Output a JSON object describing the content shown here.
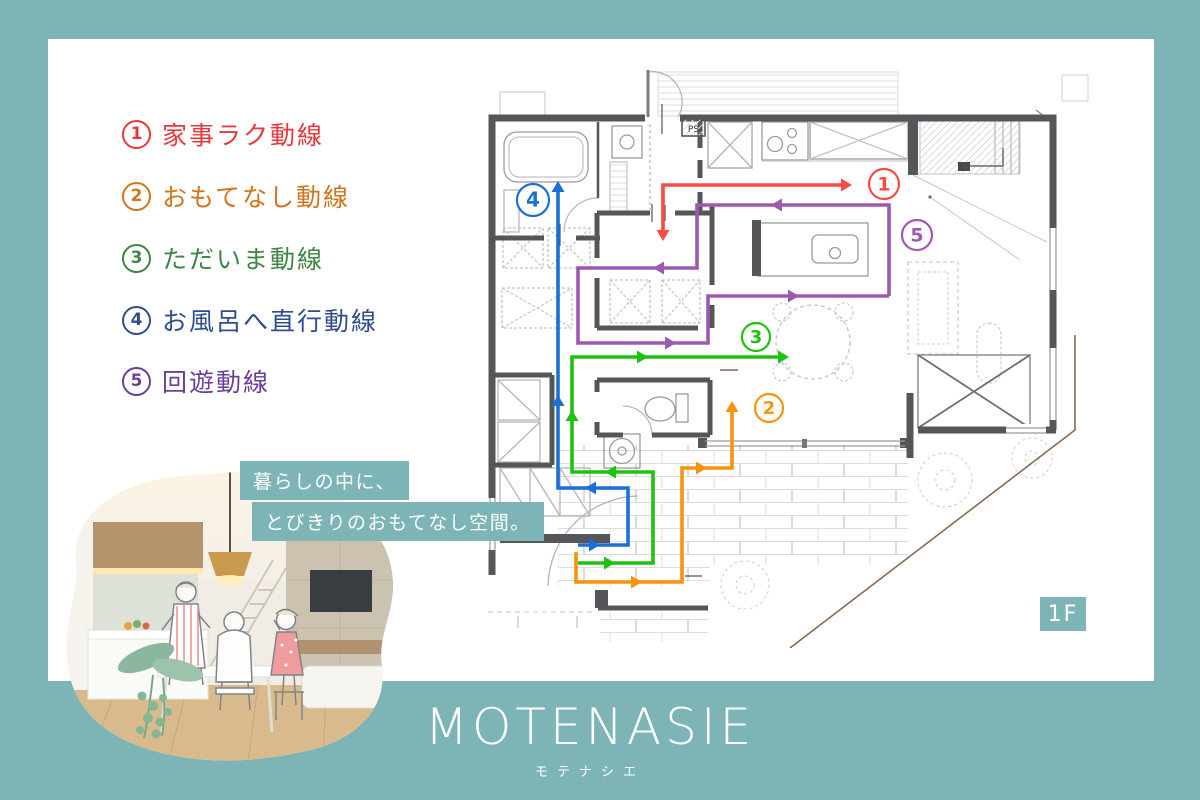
{
  "palette": {
    "teal": "#7db5b7",
    "card_bg": "#ffffff",
    "wall": "#55565a",
    "plan_line": "#9b9b9b",
    "property_line": "#8a6a50"
  },
  "legend": {
    "items": [
      {
        "number": "1",
        "label": "家事ラク動線",
        "color": "#e8383d"
      },
      {
        "number": "2",
        "label": "おもてなし動線",
        "color": "#d1761b"
      },
      {
        "number": "3",
        "label": "ただいま動線",
        "color": "#3d8544"
      },
      {
        "number": "4",
        "label": "お風呂へ直行動線",
        "color": "#2e4d91"
      },
      {
        "number": "5",
        "label": "回遊動線",
        "color": "#6a3f9b"
      }
    ]
  },
  "bubble": {
    "line1": "暮らしの中に、",
    "line2": "とびきりのおもてなし空間。"
  },
  "logo": {
    "name": "MOTENASIE",
    "kana": "モテナシエ"
  },
  "plan": {
    "floor_label": "1F",
    "ps_label": "PS",
    "routes": [
      {
        "number": "1",
        "name": "kaji-raku-dousen",
        "color": "#fa4b43",
        "points": "183,176 183,125 366,125",
        "arrows": [
          {
            "x": 183,
            "y": 181,
            "d": "down"
          },
          {
            "x": 372,
            "y": 125,
            "d": "right"
          }
        ],
        "badge": {
          "x": 404,
          "y": 124,
          "r": 15
        }
      },
      {
        "number": "2",
        "name": "omotenashi-dousen",
        "color": "#f7930f",
        "points": "96,492 96,522 202,522 202,408 252,408 252,347",
        "arrows": [
          {
            "x": 162,
            "y": 522,
            "d": "right"
          },
          {
            "x": 227,
            "y": 408,
            "d": "right"
          },
          {
            "x": 252,
            "y": 341,
            "d": "up"
          }
        ],
        "badge": {
          "x": 289,
          "y": 348,
          "r": 14
        }
      },
      {
        "number": "3",
        "name": "tadaima-dousen",
        "color": "#1fc20f",
        "points": "98,503 173,503 173,412 92,412 92,297 303,297",
        "arrows": [
          {
            "x": 135,
            "y": 503,
            "d": "right"
          },
          {
            "x": 125,
            "y": 412,
            "d": "left"
          },
          {
            "x": 92,
            "y": 350,
            "d": "up"
          },
          {
            "x": 168,
            "y": 297,
            "d": "right"
          },
          {
            "x": 309,
            "y": 297,
            "d": "right"
          }
        ],
        "badge": {
          "x": 276,
          "y": 277,
          "r": 14
        }
      },
      {
        "number": "4",
        "name": "ofuro-chokkou-dousen",
        "color": "#1b6fd6",
        "points": "98,485 148,485 148,428 78,428 78,127",
        "arrows": [
          {
            "x": 120,
            "y": 485,
            "d": "right"
          },
          {
            "x": 105,
            "y": 428,
            "d": "left"
          },
          {
            "x": 78,
            "y": 335,
            "d": "up"
          },
          {
            "x": 78,
            "y": 121,
            "d": "up"
          }
        ],
        "badge": {
          "x": 53,
          "y": 140,
          "r": 16
        }
      },
      {
        "number": "5",
        "name": "kaiyuu-dousen",
        "color": "#9d58b0",
        "points": "409,236 409,145 217,145 217,208 98,208 98,283 228,283 228,236 409,236",
        "arrows": [
          {
            "x": 291,
            "y": 145,
            "d": "left"
          },
          {
            "x": 173,
            "y": 208,
            "d": "left"
          },
          {
            "x": 196,
            "y": 283,
            "d": "right"
          },
          {
            "x": 319,
            "y": 236,
            "d": "right"
          }
        ],
        "badge": {
          "x": 437,
          "y": 175,
          "r": 15
        }
      }
    ]
  }
}
